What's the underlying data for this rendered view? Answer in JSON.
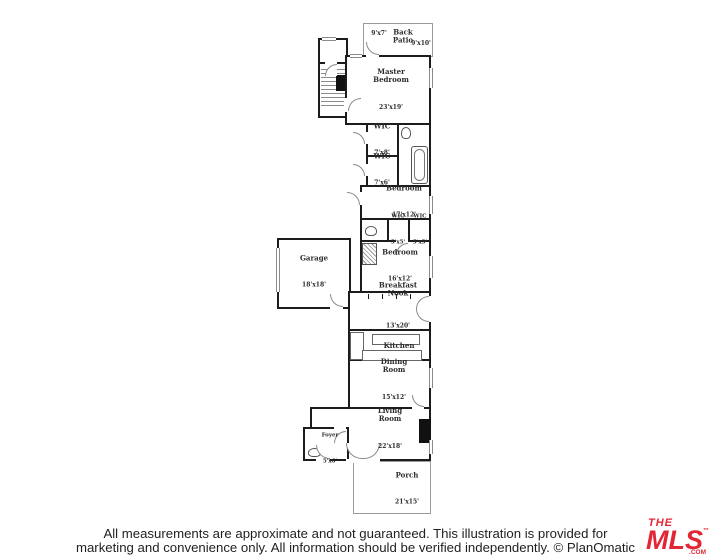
{
  "rooms": [
    {
      "key": "back-patio",
      "label": "Back\nPatio",
      "dims": "9'x10'",
      "dims2": "9'x7'"
    },
    {
      "key": "master-bedroom",
      "label": "Master\nBedroom",
      "dims": "23'x19'"
    },
    {
      "key": "wic-1",
      "label": "WIC",
      "dims": "7'x8'"
    },
    {
      "key": "wic-2",
      "label": "WIC",
      "dims": "7'x6'"
    },
    {
      "key": "bedroom-1",
      "label": "Bedroom",
      "dims": "17'x12'"
    },
    {
      "key": "wic-3",
      "label": "WIC",
      "dims": "5'x5'"
    },
    {
      "key": "wic-4",
      "label": "WIC",
      "dims": "5'x5'"
    },
    {
      "key": "bedroom-2",
      "label": "Bedroom",
      "dims": "16'x12'"
    },
    {
      "key": "garage",
      "label": "Garage",
      "dims": "18'x18'"
    },
    {
      "key": "breakfast-nook",
      "label": "Breakfast\nNook",
      "dims": "13'x20'"
    },
    {
      "key": "kitchen",
      "label": "Kitchen",
      "dims": ""
    },
    {
      "key": "dining-room",
      "label": "Dining\nRoom",
      "dims": "15'x12'"
    },
    {
      "key": "living-room",
      "label": "Living\nRoom",
      "dims": "22'x18'"
    },
    {
      "key": "foyer",
      "label": "Foyer",
      "dims": "5'x6'"
    },
    {
      "key": "porch",
      "label": "Porch",
      "dims": "21'x15'"
    }
  ],
  "footer": {
    "line1": "All measurements are approximate and not guaranteed. This illustration is provided for",
    "line2": "marketing and convenience only. All information should be verified independently. © PlanOmatic"
  },
  "logo": {
    "the": "THE",
    "mls": "MLS",
    "tm": "™",
    "com": ".COM",
    "color": "#e32636"
  }
}
